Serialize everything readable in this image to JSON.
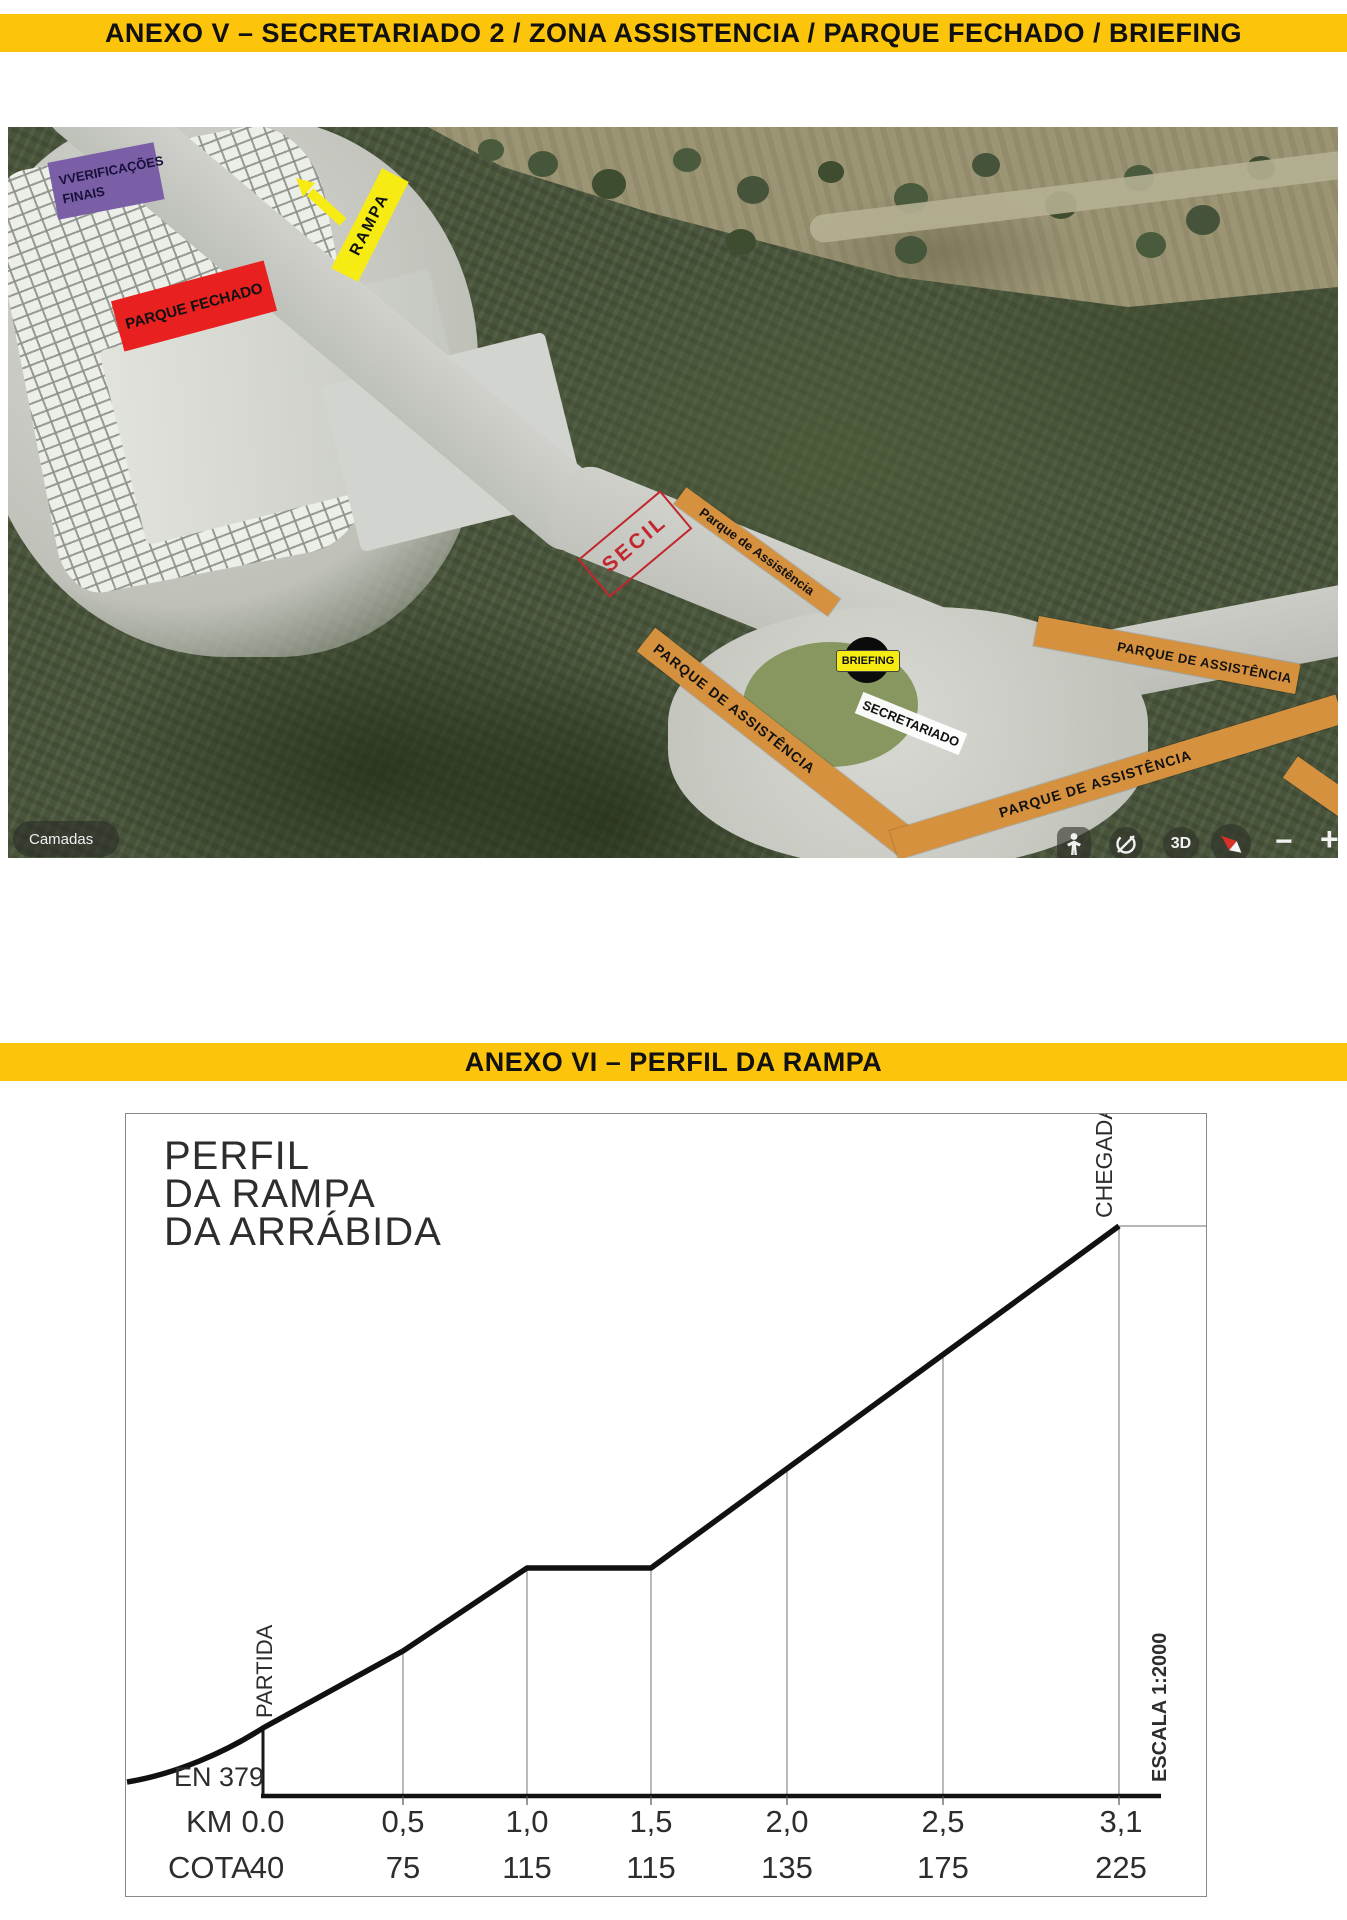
{
  "colors": {
    "header_band": "#fcc40a",
    "orange_bar": "#d6913f",
    "bright_yellow": "#f6ec13",
    "red_box": "#e8201f",
    "purple_box": "#7a5fa6",
    "secil_red": "#c1272d"
  },
  "anexo_v": {
    "title": "ANEXO V – SECRETARIADO 2 / ZONA ASSISTENCIA / PARQUE FECHADO / BRIEFING"
  },
  "anexo_vi": {
    "title": "ANEXO VI – PERFIL DA RAMPA"
  },
  "map": {
    "verificacoes_line1": "VVERIFICAÇÕES",
    "verificacoes_line2": "FINAIS",
    "parque_fechado": "PARQUE FECHADO",
    "rampa": "RAMPA",
    "secil": "SECIL",
    "parque_assistencia_mixed": "Parque de Assistência",
    "briefing": "BRIEFING",
    "secretariado": "SECRETARIADO",
    "parque_assistencia_caps": "PARQUE DE ASSISTÊNCIA",
    "controls": {
      "camadas": "Camadas",
      "view_3d": "3D",
      "zoom_out": "−",
      "zoom_in": "+"
    }
  },
  "chart_data": {
    "type": "line",
    "title": "PERFIL DA RAMPA DA ARRÁBIDA",
    "title_lines": [
      "PERFIL",
      "DA RAMPA",
      "DA ARRÁBIDA"
    ],
    "x_axis_label": "KM",
    "y_axis_label": "COTA",
    "km": [
      "0.0",
      "0,5",
      "1,0",
      "1,5",
      "2,0",
      "2,5",
      "3,1"
    ],
    "cota": [
      "40",
      "75",
      "115",
      "115",
      "135",
      "175",
      "225"
    ],
    "km_values": [
      0,
      0.5,
      1,
      1.5,
      2,
      2.5,
      3.1
    ],
    "cota_values": [
      40,
      75,
      115,
      115,
      135,
      175,
      225
    ],
    "start_label": "PARTIDA",
    "finish_label": "CHEGADA",
    "road_label": "EN 379",
    "scale_label": "ESCALA 1:2000",
    "legend_position": "none",
    "grid": "vertical-drop-lines"
  }
}
